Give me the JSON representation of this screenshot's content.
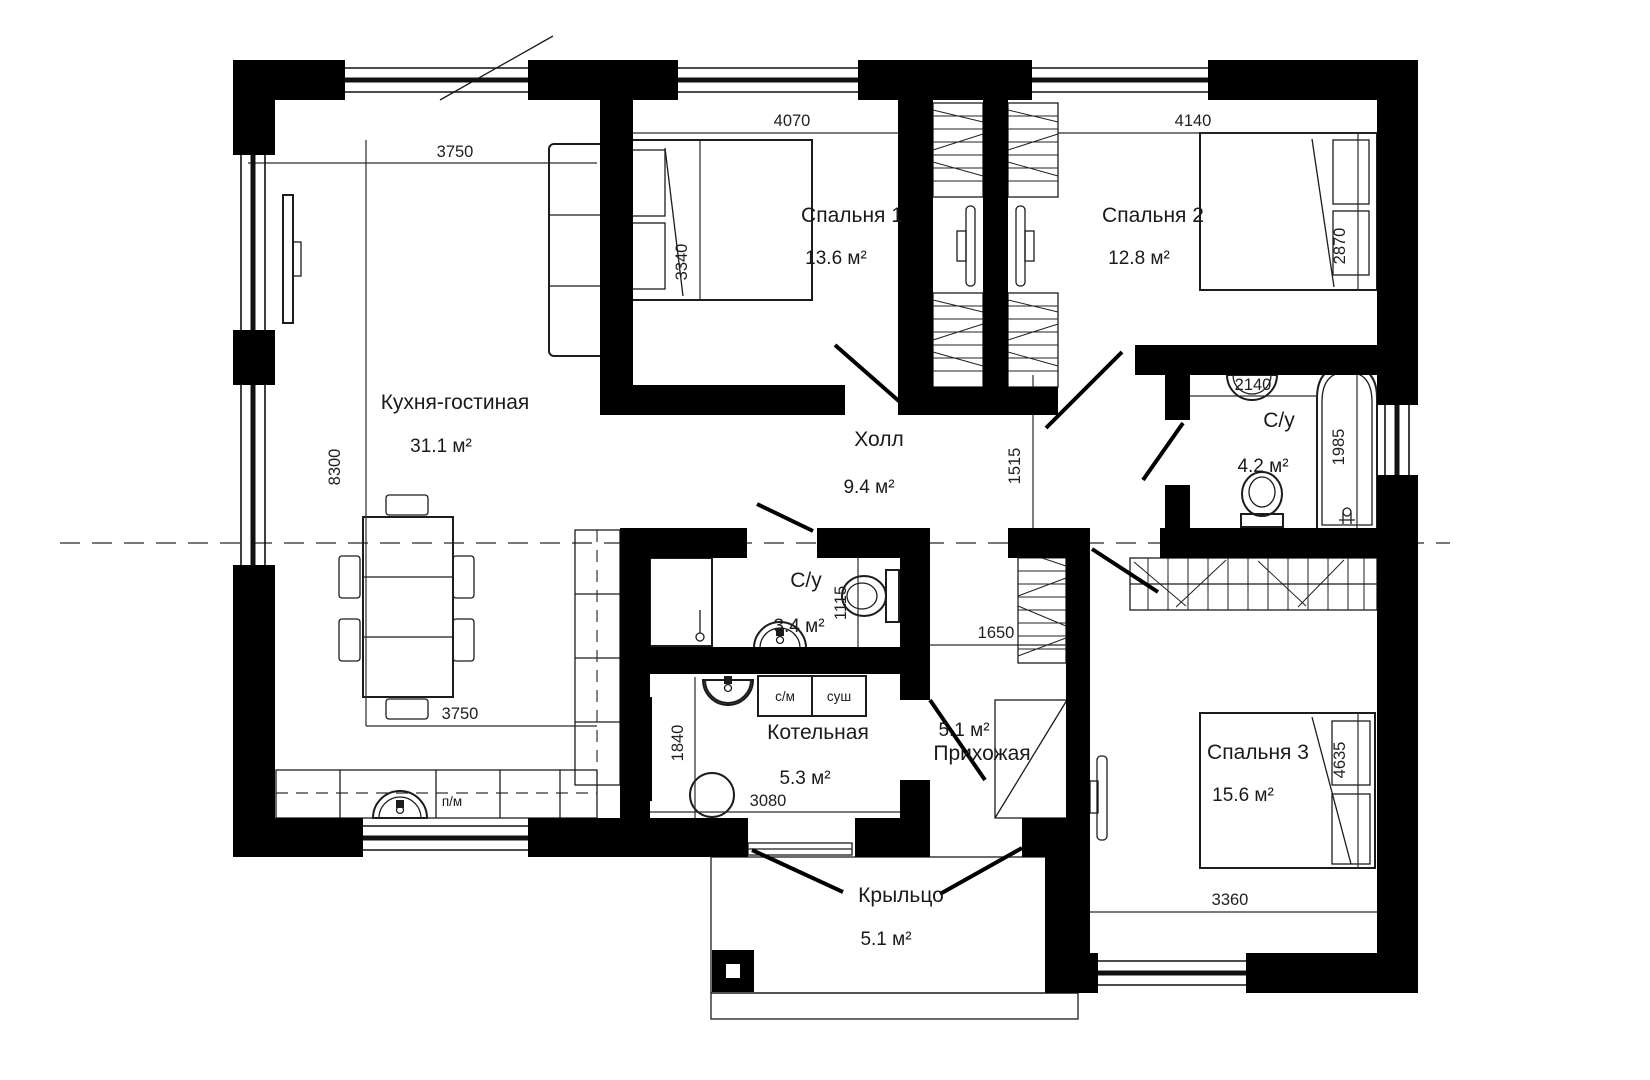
{
  "plan": {
    "bg": "#ffffff",
    "wall_color": "#000000",
    "line_color": "#222222"
  },
  "rooms": {
    "kitchen_living": {
      "name": "Кухня-гостиная",
      "area": "31.1 м²"
    },
    "bedroom1": {
      "name": "Спальня 1",
      "area": "13.6 м²"
    },
    "bedroom2": {
      "name": "Спальня 2",
      "area": "12.8 м²"
    },
    "bedroom3": {
      "name": "Спальня 3",
      "area": "15.6 м²"
    },
    "hall": {
      "name": "Холл",
      "area": "9.4 м²"
    },
    "bathroom": {
      "name": "С/у",
      "area": "4.2 м²"
    },
    "wc": {
      "name": "С/у",
      "area": "3.4 м²"
    },
    "boiler": {
      "name": "Котельная",
      "area": "5.3 м²"
    },
    "entry": {
      "name": "Прихожая",
      "area": "5.1 м²"
    },
    "porch": {
      "name": "Крыльцо",
      "area": "5.1 м²"
    }
  },
  "dims": {
    "kitchen_top": "3750",
    "kitchen_left": "8300",
    "kitchen_bottom": "3750",
    "bedroom1_top": "4070",
    "bedroom1_side": "3340",
    "bedroom2_top": "4140",
    "bedroom2_side": "2870",
    "hall_side": "1515",
    "bathroom_top": "2140",
    "bathroom_tub": "1985",
    "wc_side": "1115",
    "wardrobe": "1650",
    "boiler_side": "1840",
    "boiler_bottom": "3080",
    "bedroom3_side": "4635",
    "bedroom3_bottom": "3360"
  },
  "appliances": {
    "washing_machine": "с/м",
    "dryer": "суш",
    "dishwasher": "п/м"
  }
}
